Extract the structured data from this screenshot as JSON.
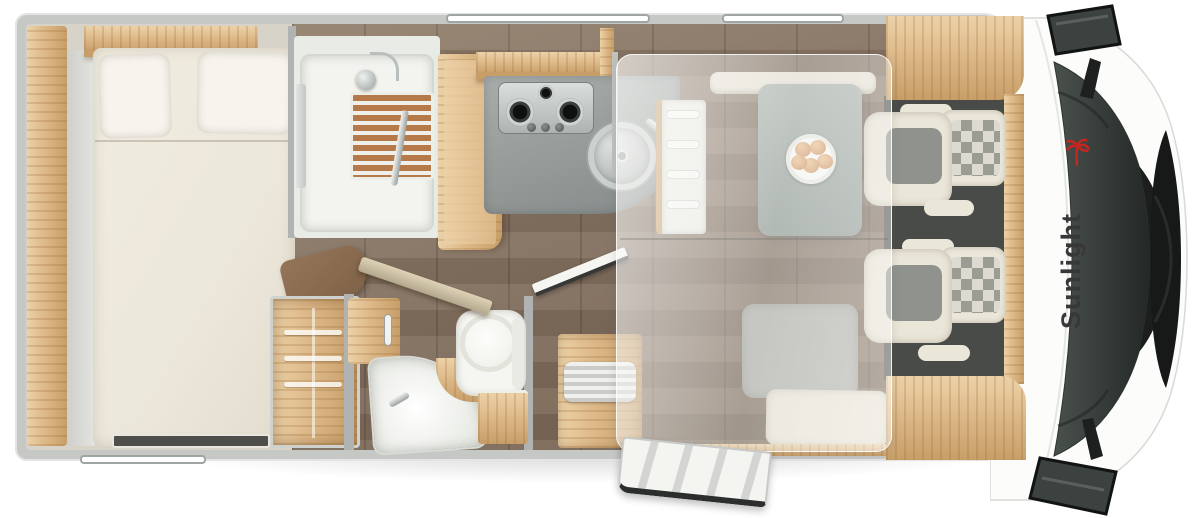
{
  "image": {
    "kind": "top-down 3D rendered motorhome floor plan",
    "width_px": 1200,
    "height_px": 518
  },
  "logo": {
    "text": "Sunlight",
    "text_color": "#38383a",
    "palm_color": "#c9251f"
  },
  "palette": {
    "bg": "#ffffff",
    "wall": "#c6c8c6",
    "wallDark": "#b0b3b1",
    "interior": "#d7d3c9",
    "wood": "#e0bd8e",
    "woodHi": "#ecd2a8",
    "woodLo": "#c79e68",
    "woodDeep": "#7e6146",
    "doorTan": "#cec1a4",
    "floorA": "#93816e",
    "floorB": "#7e6b5b",
    "mattress": "#ece7db",
    "pillow": "#f6f4ed",
    "cream": "#eae6d8",
    "seatGray": "#90938d",
    "benchGray": "#aeb0aa",
    "table": "#9aa59f",
    "counter": "#9aa09f",
    "counterLo": "#858b8a",
    "steel": "#ccd1d0",
    "cabFloor": "#484b47",
    "glassA": "#4a514d",
    "glassB": "#232826",
    "grille": "#161918",
    "overlayA": "rgba(253,253,251,.66)",
    "overlayB": "rgba(236,236,234,.38)",
    "white": "#f5f5f1",
    "teak": "#b5794a",
    "trayWhite": "#f3f3ef",
    "logoText": "#38383a",
    "logoRed": "#c9251f",
    "windowBorder": "#9fa5a2"
  },
  "objects": {
    "rooms": [
      "rear-bedroom",
      "shower",
      "washroom",
      "kitchen",
      "dinette",
      "driver-cab"
    ],
    "furniture": [
      "french-bed",
      "pillows",
      "overhead-cabinets",
      "wardrobe-with-hangers",
      "shower-tray-with-teak-grate",
      "shower-head",
      "larder-cabinet",
      "gas-hob-3-burner",
      "round-sink-with-lid",
      "dinette-table",
      "plate-with-bread-rolls",
      "bench-seat",
      "bunk-ladder",
      "drop-down-bed-translucent",
      "corner-washbasin",
      "cassette-toilet",
      "vanity-cabinet",
      "tambour-cabinet",
      "entry-step",
      "open-entry-door-with-steps",
      "swivel-captain-seat-driver",
      "swivel-captain-seat-passenger",
      "windshield",
      "front-grille",
      "side-mirror-left",
      "side-mirror-right"
    ],
    "windows": [
      "top-wall-window-long",
      "top-wall-window-short",
      "rear-bottom-window"
    ]
  }
}
